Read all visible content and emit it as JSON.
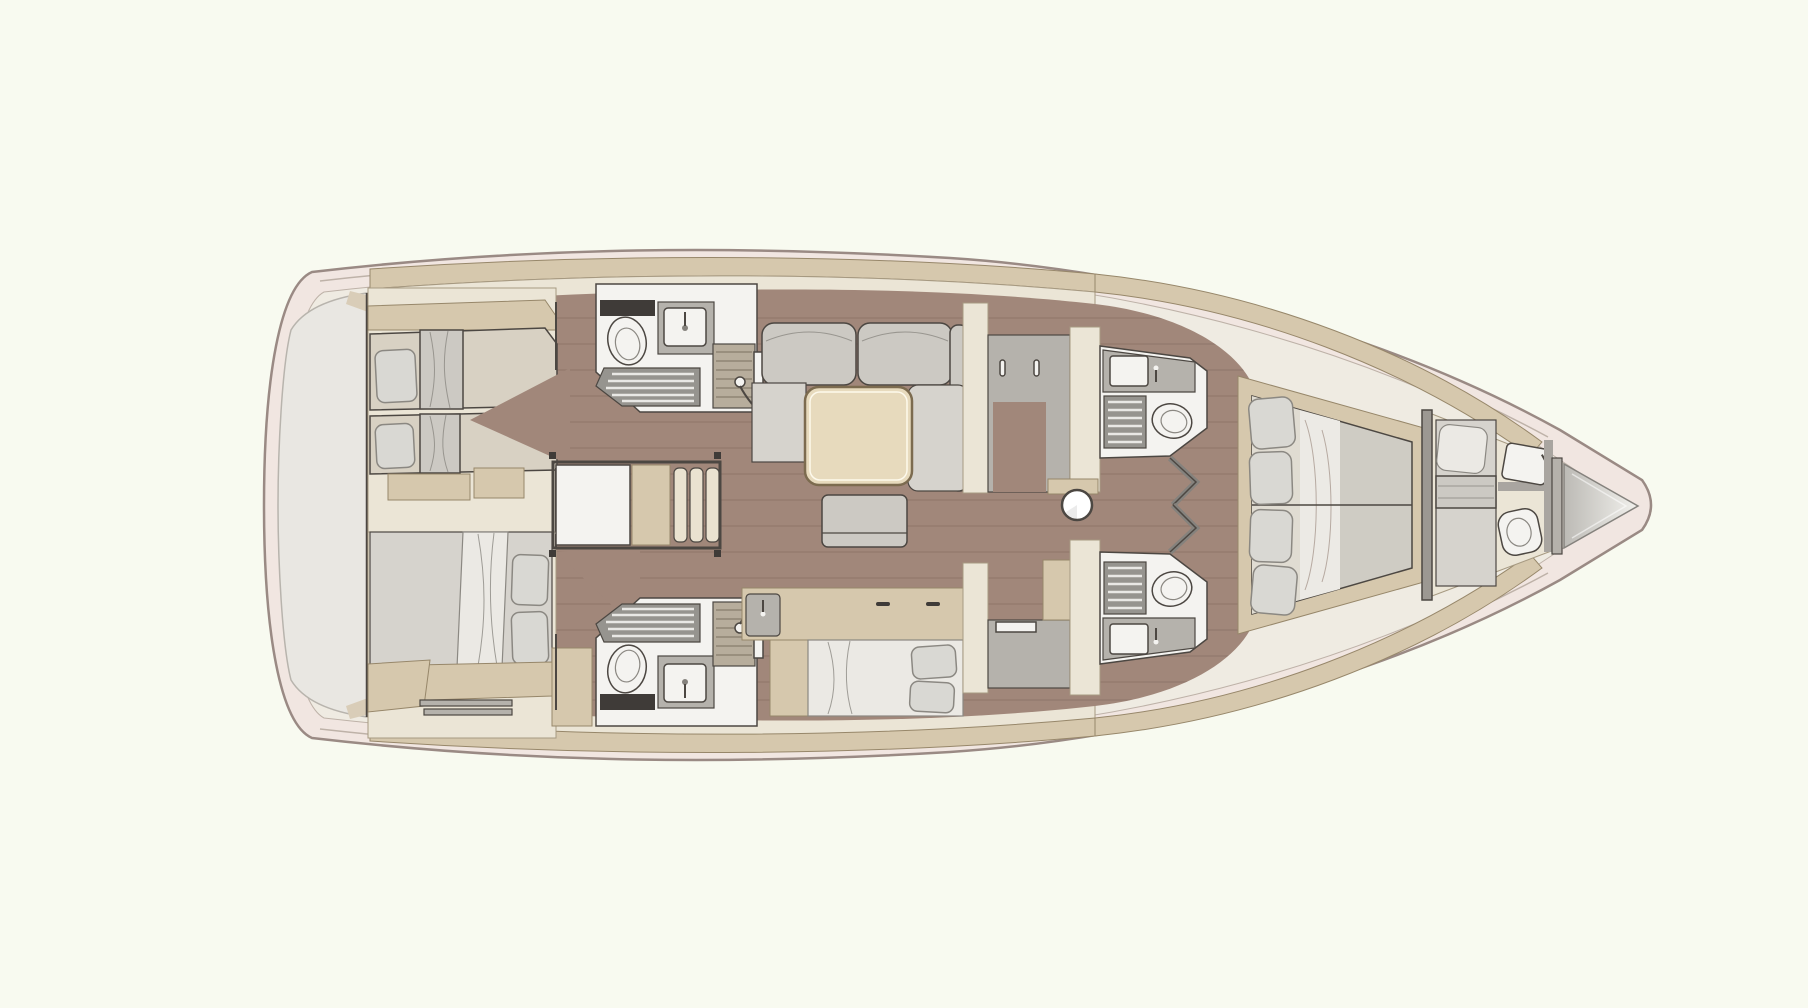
{
  "meta": {
    "type": "sailing-yacht-interior-floor-plan",
    "view": "top-down",
    "bow": "right",
    "stern": "left"
  },
  "colors": {
    "background": "#f8faf0",
    "hull_band": "#f1e6e1",
    "hull_outline": "#9a8a84",
    "deck_inner": "#efebe2",
    "deck_edge": "#beb2a8",
    "transom": "#e9e7e2",
    "transom_edge": "#b8b4ad",
    "furniture_tan": "#d6c8ad",
    "furniture_tan_edge": "#97876a",
    "cream_panel": "#ebe5d6",
    "panel_edge": "#a79a82",
    "wood_floor": "#a1877a",
    "wood_seam": "#82695d",
    "mattress": "#d8d1c3",
    "upholstery": "#ccc9c3",
    "upholstery_light": "#d6d3cd",
    "bedding": "#ebe9e4",
    "pillow": "#d9d8d3",
    "pillow_edge": "#8b8882",
    "fixture_white": "#f4f3f0",
    "outline": "#4c4742",
    "shower_grate": "#96948f",
    "grate_slat": "#e9e8e5",
    "teak_grate": "#b7ad9c",
    "teak_slat": "#8f8574",
    "gray_counter": "#b5b2ac",
    "dark_trim": "#3f3b38",
    "door_gray": "#85827d",
    "table_wood": "#e7dabd",
    "table_edge": "#7c6b4f",
    "step_cream": "#eae2d0",
    "mast": "#ffffff",
    "locker_start": "#bcbab5",
    "locker_end": "#f2f1ed"
  },
  "vessel": {
    "rooms": [
      {
        "id": "transom-garage",
        "fixtures": []
      },
      {
        "id": "aft-cabin-port",
        "fixtures": [
          "single-berth",
          "single-berth",
          "pillow",
          "pillow",
          "hull-shelf",
          "step-bench"
        ]
      },
      {
        "id": "aft-cabin-starboard",
        "fixtures": [
          "double-berth",
          "pillow",
          "pillow",
          "hull-shelf",
          "drawer-front"
        ]
      },
      {
        "id": "aft-head-port",
        "fixtures": [
          "toilet",
          "washbasin",
          "shower-grate",
          "teak-shower-stall",
          "shower-mixer"
        ]
      },
      {
        "id": "aft-head-starboard",
        "fixtures": [
          "toilet",
          "washbasin",
          "shower-grate",
          "teak-shower-stall",
          "shower-mixer"
        ]
      },
      {
        "id": "companionway",
        "fixtures": [
          "landing",
          "side-platform",
          "step",
          "step",
          "step"
        ]
      },
      {
        "id": "saloon",
        "fixtures": [
          "l-shaped-sofa",
          "chaise",
          "dining-table",
          "ottoman"
        ]
      },
      {
        "id": "starboard-settee",
        "fixtures": [
          "sideboard",
          "wet-bar-sink",
          "settee-cushion",
          "pillow",
          "pillow"
        ]
      },
      {
        "id": "galley",
        "fixtures": [
          "cabinet-unit",
          "counter",
          "mast-post"
        ]
      },
      {
        "id": "forward-head-port",
        "fixtures": [
          "washbasin",
          "shower-grate",
          "toilet",
          "folding-door"
        ]
      },
      {
        "id": "forward-head-starboard",
        "fixtures": [
          "washbasin",
          "shower-grate",
          "toilet",
          "folding-door"
        ]
      },
      {
        "id": "owners-cabin",
        "fixtures": [
          "v-berth",
          "pillow",
          "pillow",
          "pillow",
          "pillow"
        ]
      },
      {
        "id": "crew-cabin",
        "fixtures": [
          "single-berth",
          "pillow",
          "washbasin",
          "toilet"
        ]
      },
      {
        "id": "anchor-locker",
        "fixtures": []
      }
    ]
  }
}
